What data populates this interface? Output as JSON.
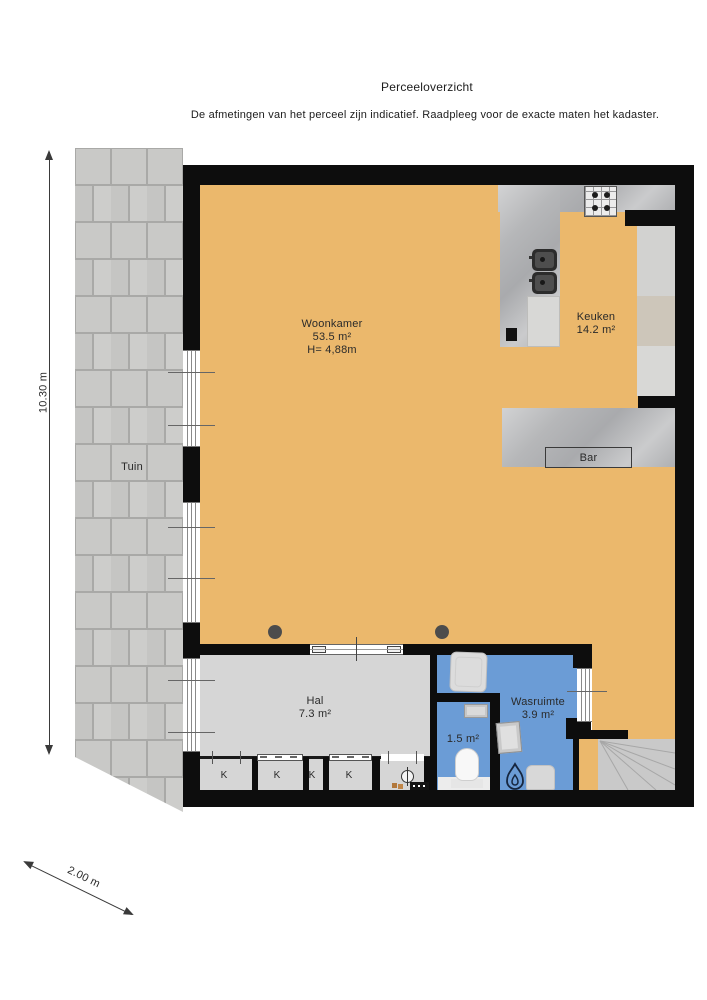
{
  "header": {
    "title": "Perceeloverzicht",
    "disclaimer": "De afmetingen van het perceel zijn indicatief. Raadpleeg voor de exacte maten het kadaster."
  },
  "rooms": {
    "woonkamer": {
      "name": "Woonkamer",
      "area": "53.5 m²",
      "ceiling_height": "H= 4,88m"
    },
    "keuken": {
      "name": "Keuken",
      "area": "14.2 m²"
    },
    "bar": {
      "name": "Bar"
    },
    "tuin": {
      "name": "Tuin"
    },
    "hal": {
      "name": "Hal",
      "area": "7.3 m²"
    },
    "wasruimte": {
      "name": "Wasruimte",
      "area": "3.9 m²"
    },
    "toilet": {
      "area": "1.5 m²"
    },
    "closets": {
      "labels": [
        "K",
        "K",
        "K",
        "K"
      ]
    }
  },
  "dimensions": {
    "side": "10.30 m",
    "bottom": "2.00 m"
  },
  "colors": {
    "floor_orange": "#ebb86c",
    "wet_room_blue": "#6b9cd6",
    "hall_gray": "#d6d6d6",
    "wall_black": "#0d0d0d",
    "counter_marble": "#b6b7b9",
    "garden_paver": "#c9c9c7",
    "stairs_gray": "#c9c9c9"
  },
  "icons": {
    "stove": "gas-hob-4-burners",
    "sinks": "double-kitchen-sink",
    "washing_machine": "washing-machine",
    "boiler": "flame",
    "toilet": "toilet-bowl",
    "hand_sink": "small-sink",
    "dryer": "dryer",
    "electric_meter": "meter-circle",
    "stairs": "winder-stairs",
    "dimension_arrows": "double-headed-arrow"
  }
}
